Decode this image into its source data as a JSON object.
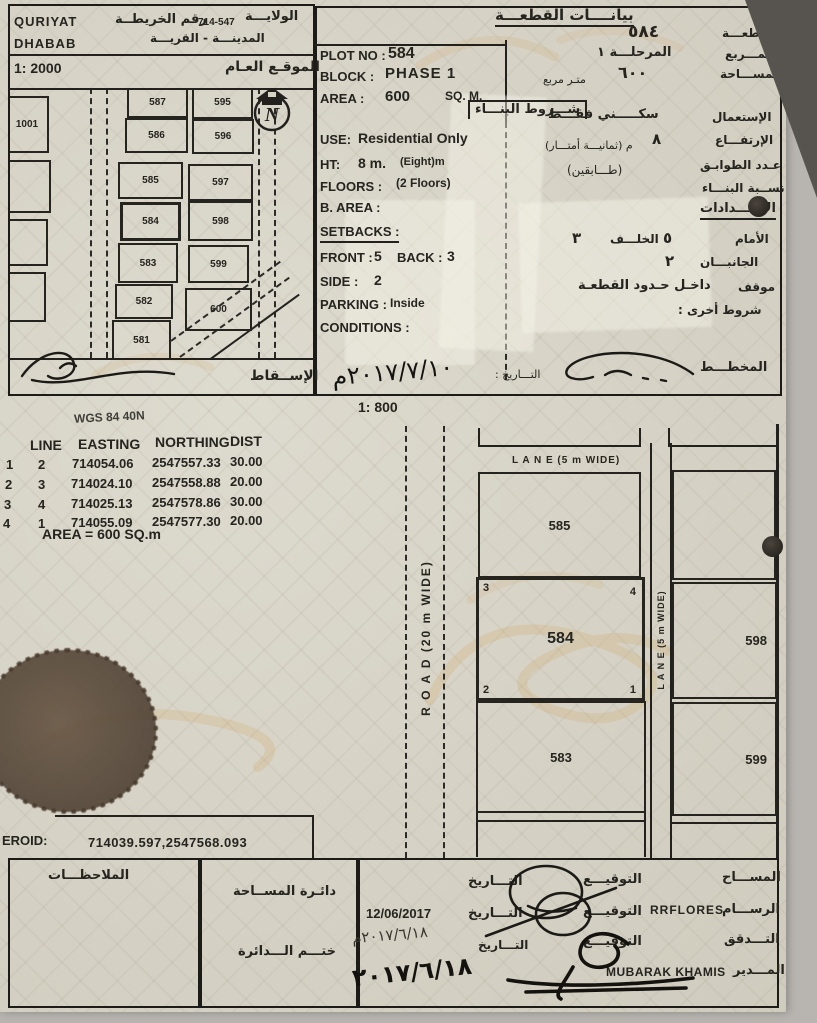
{
  "doc": {
    "header_left": {
      "wilaya_value": "QURIYAT",
      "village_value": "DHABAB",
      "map_no_label": "رقم الخريطــة",
      "map_no": "714-547",
      "wilaya_label": "الولايـــة",
      "town_label": "المدينـــة - القريـــة",
      "scale_main": "1: 2000",
      "general_location": "الموقـع العـام",
      "projection": "الإســقاط"
    },
    "site_map": {
      "north_letter": "N",
      "plots": [
        "1001",
        "587",
        "595",
        "586",
        "596",
        "585",
        "597",
        "584",
        "598",
        "583",
        "599",
        "582",
        "600",
        "581"
      ]
    },
    "plot_en": {
      "plot_no_label": "PLOT NO :",
      "plot_no": "584",
      "block_label": "BLOCK :",
      "block": "PHASE 1",
      "area_label": "AREA :",
      "area": "600",
      "area_unit": "SQ. M.",
      "use_label": "USE:",
      "use": "Residential Only",
      "ht_label": "HT:",
      "ht": "8 m.",
      "ht_words": "(Eight)m",
      "floors_label": "FLOORS :",
      "floors": "(2 Floors)",
      "barea_label": "B. AREA :",
      "setbacks_label": "SETBACKS :",
      "front_label": "FRONT :",
      "front": "5",
      "back_label": "BACK :",
      "back": "3",
      "side_label": "SIDE :",
      "side": "2",
      "parking_label": "PARKING :",
      "parking": "Inside",
      "conditions_label": "CONDITIONS :",
      "date_label": "التـــاريخ :",
      "date_handwritten": "٢٠١٧/٧/١٠م"
    },
    "plot_ar": {
      "title": "بيانــــات القطعـــة",
      "plot_label": "القطعـــة",
      "plot_value": "٥٨٤",
      "block_label": "المـــربع",
      "block_value": "المرحلـــة ١",
      "area_label": "المســـاحة",
      "area_value": "٦٠٠",
      "area_unit": "متـر مربع",
      "conditions_title": "شـــروط البنـــاء",
      "use_label": "الإستعمال",
      "use_value": "سكـــــني فقـــط",
      "height_label": "الإرتفـــاع",
      "height_value": "٨",
      "height_words": "م (ثمانيـــة أمتـــار)",
      "floors_label": "عـدد الطوابـق",
      "floors_value": "(طـــابقين)",
      "ratio_label": "نســبة البنـــاء",
      "setbacks_label": "الإرتـــدادات",
      "front_label": "الأمام",
      "front_value": "٥",
      "back_label": "الخلـــف",
      "back_value": "٣",
      "sides_label": "الجانبـــان",
      "sides_value": "٢",
      "parking_label": "موقف",
      "parking_value": "داخـل حـدود القطعـة",
      "other_label": "شروط أخرى :",
      "planner_label": "المخطـــط"
    },
    "coords": {
      "datum": "WGS 84  40N",
      "h_line": "LINE",
      "h_easting": "EASTING",
      "h_northing": "NORTHING",
      "h_dist": "DIST",
      "rows": [
        {
          "a": "1",
          "b": "2",
          "e": "714054.06",
          "n": "2547557.33",
          "d": "30.00"
        },
        {
          "a": "2",
          "b": "3",
          "e": "714024.10",
          "n": "2547558.88",
          "d": "20.00"
        },
        {
          "a": "3",
          "b": "4",
          "e": "714025.13",
          "n": "2547578.86",
          "d": "30.00"
        },
        {
          "a": "4",
          "b": "1",
          "e": "714055.09",
          "n": "2547577.30",
          "d": "20.00"
        }
      ],
      "area_line": "AREA = 600  SQ.m"
    },
    "detail_map": {
      "scale": "1: 800",
      "lane_top": "L A N E (5 m WIDE)",
      "lane_right": "L A N E (5 m WIDE)",
      "road": "R O A D (20 m WIDE)",
      "plot_main": "584",
      "plot_north": "585",
      "plot_south": "583",
      "plot_east": "598",
      "plot_southeast": "599",
      "c1": "1",
      "c2": "2",
      "c3": "3",
      "c4": "4"
    },
    "centroid": {
      "label": "EROID:",
      "value": "714039.597,2547568.093"
    },
    "footer": {
      "notes": "الملاحظـــات",
      "survey_dept": "دائـرة المســاحة",
      "stamp": "ختـــم الـــدائرة",
      "surveyor_label": "المســـاح",
      "draftsman_label": "الرســـام",
      "draftsman_name": "RRFLORES",
      "checked_label": "التـــدقق",
      "director_label": "المـــدير",
      "director_name": "MUBARAK KHAMIS",
      "sign_label": "التوقيـــع",
      "date_label": "التـــاريخ",
      "draft_date": "12/06/2017",
      "check_date": "٢٠١٧/٦/١٨م",
      "director_date": "٢٠١٧/٦/١٨"
    }
  }
}
